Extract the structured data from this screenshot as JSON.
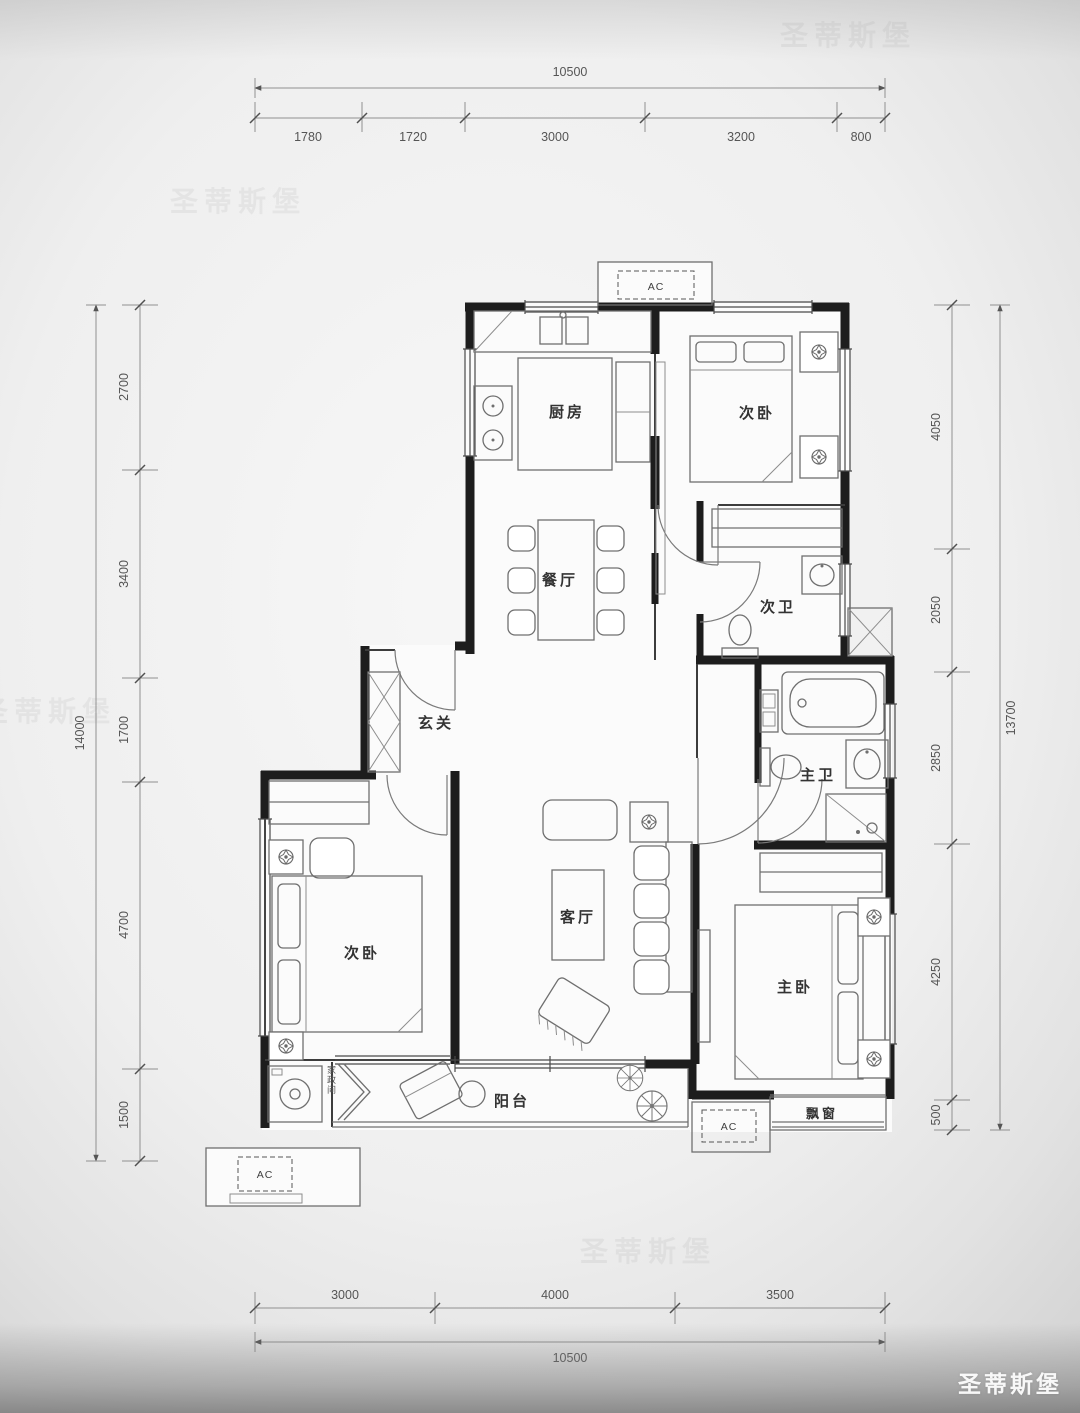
{
  "meta": {
    "doc_type": "floor-plan"
  },
  "watermark": {
    "brand": "圣蒂斯堡"
  },
  "dimensions": {
    "top": {
      "total": "10500",
      "segments": [
        "1780",
        "1720",
        "3000",
        "3200",
        "800"
      ]
    },
    "left": {
      "total": "14000",
      "segments": [
        "2700",
        "3400",
        "1700",
        "4700",
        "1500"
      ]
    },
    "right": {
      "total": "13700",
      "segments": [
        "4050",
        "2050",
        "2850",
        "4250",
        "500"
      ]
    },
    "bottom": {
      "total": "10500",
      "segments": [
        "3000",
        "4000",
        "3500"
      ]
    }
  },
  "rooms": {
    "kitchen": "厨房",
    "bedroom2": "次卧",
    "bath2": "次卫",
    "dining": "餐厅",
    "foyer": "玄关",
    "bedroom3": "次卧",
    "living": "客厅",
    "master_bath": "主卫",
    "master_bedroom": "主卧",
    "balcony": "阳台",
    "bay_window": "飘窗",
    "laundry": "家政间"
  },
  "labels": {
    "ac": "AC"
  }
}
